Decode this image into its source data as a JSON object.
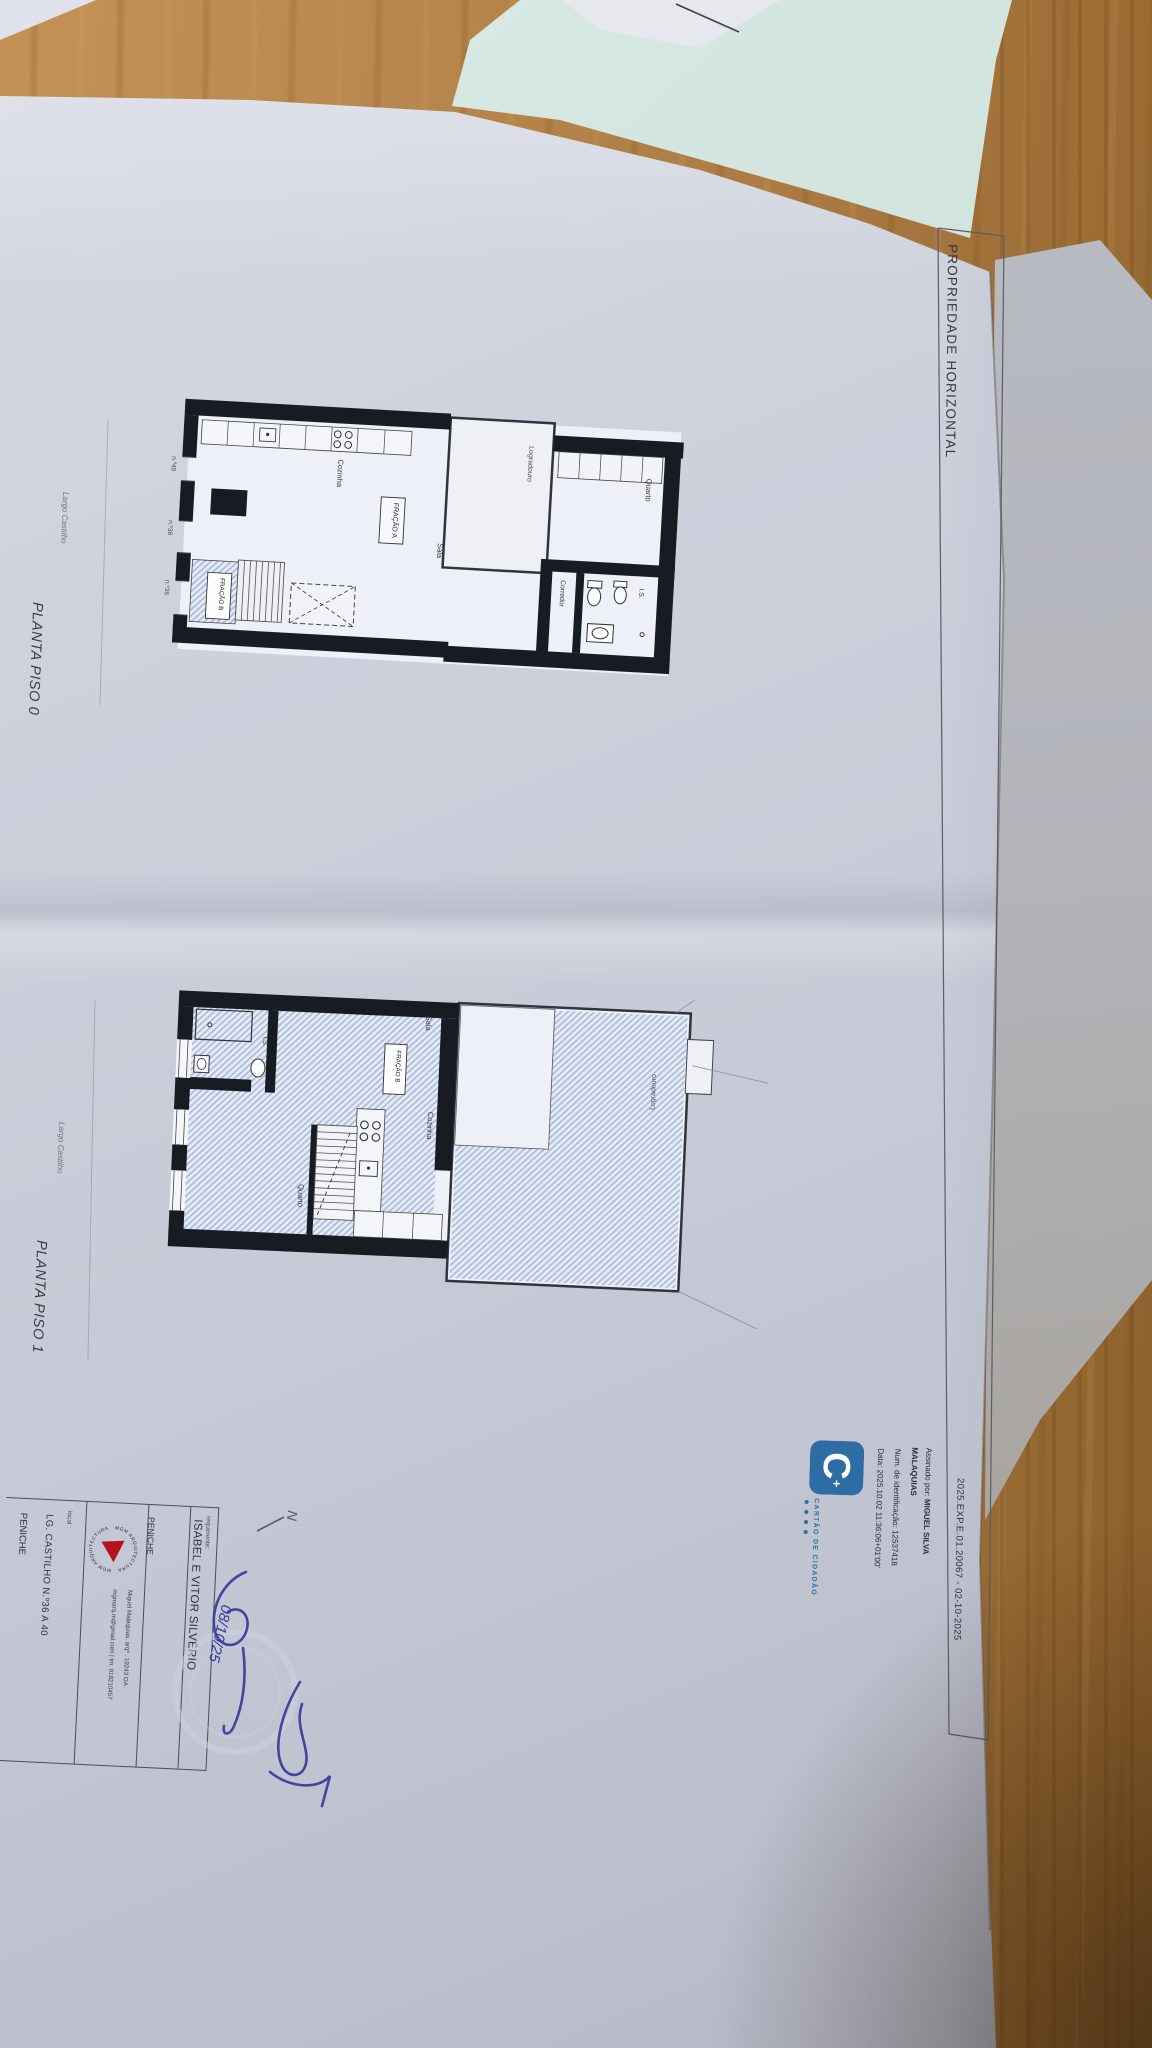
{
  "scene": {
    "colors": {
      "wood": "#b8884e",
      "wood_shadow": "#8a5e2b",
      "paper": "#c6cad6",
      "under_paper": "#b2b4ba",
      "mint_paper": "#cbdfd9",
      "plan_wall": "#171b22",
      "hatch_blue": "#aabbdc",
      "ink_blue": "#373b9d",
      "cc_blue": "#2e6da4",
      "logo_red": "#b5121f",
      "pencil": "#565b64"
    }
  },
  "document": {
    "frame_title": "PROPRIEDADE HORIZONTAL",
    "doc_code": "2025.EXP.E.01.20067 - 02-10-2025",
    "plans": [
      {
        "title": "PLANTA PISO 0",
        "street_label": "Largo Castilho",
        "unit_a_label": "FRAÇÃO A",
        "unit_b_label": "FRAÇÃO B",
        "rooms": {
          "cozinha": "Cozinha",
          "sala": "Sala",
          "quarto": "Quarto",
          "corredor": "Corredor",
          "is": "I.S.",
          "logradouro": "Logradouro"
        },
        "door_numbers": [
          "n.º40",
          "n.º38",
          "n.º36"
        ]
      },
      {
        "title": "PLANTA PISO 1",
        "street_label": "Largo Castilho",
        "unit_b_label": "FRAÇÃO B",
        "rooms": {
          "sala": "Sala",
          "cozinha": "Cozinha",
          "quarto": "Quarto",
          "is": "I.S.",
          "logradouro": "Logradouro"
        }
      }
    ],
    "digital_signature": {
      "brand": "CARTÃO DE CIDADÃO",
      "signed_by_label": "Assinado por: ",
      "signed_by_name": "MIGUEL SILVA",
      "signed_by_name_2": "MALAQUIAS",
      "id_line": "Num. de identificação: 12537418",
      "date_line": "Data: 2025.10.02 11:36:06+01'00'"
    },
    "title_block": {
      "requerente_label": "requerente:",
      "requerente_name": "ISABEL E VITOR SILVÉRIO",
      "requerente_city": "PENICHE",
      "office_arc_text": "MGM ARQUITECTURA",
      "architect_line": "Miguel Malaquias, arqº  .  19243 OA",
      "contact_line": "mgmarq.m@gmail.com  |  tm. 918210457",
      "local_label": "local :",
      "local_line": "LG. CASTILHO N.º36 A 40",
      "local_city": "PENICHE"
    },
    "annotations": {
      "north": "N",
      "handwritten_date": "08/10/25"
    }
  }
}
